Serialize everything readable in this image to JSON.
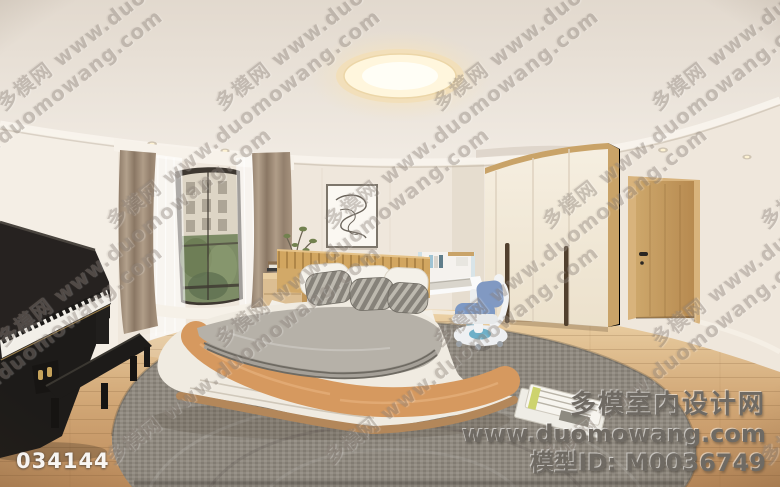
{
  "overlay": {
    "image_id": "034144",
    "brand": {
      "site_name": "多模室内设计网",
      "site_url": "www.duomowang.com",
      "model_line": "模型ID: M0036749"
    }
  },
  "watermark": {
    "cn": "多模网",
    "url": "www.duomowang.com"
  },
  "colors": {
    "wall": "#efe7dc",
    "ceiling": "#e8dfd5",
    "cornice": "#f8f3ec",
    "floor_wood": "#d5ad7c",
    "rug": "#8f897f",
    "drape": "#a08a76",
    "window_frame": "#3e3831",
    "greenery": "#7d8c66",
    "building": "#ddd5c5",
    "piano": "#211f1e",
    "headboard": "#d2a968",
    "duvet": "#b6b1a8",
    "throw": "#d6995f",
    "blanket_white": "#f0ebe1",
    "pillow_gray": "#8e8a80",
    "nightstand": "#dcbe92",
    "wardrobe": "#f3ebdb",
    "wardrobe_trim": "#c9a368",
    "door": "#c59e63",
    "desk_accent": "#9fc3d3",
    "chair_blue": "#7e99c4",
    "light_warm": "#fff6dd",
    "watermark": "#8d837b",
    "id_text": "#ffffff",
    "brand_text": "#6f6a63"
  }
}
